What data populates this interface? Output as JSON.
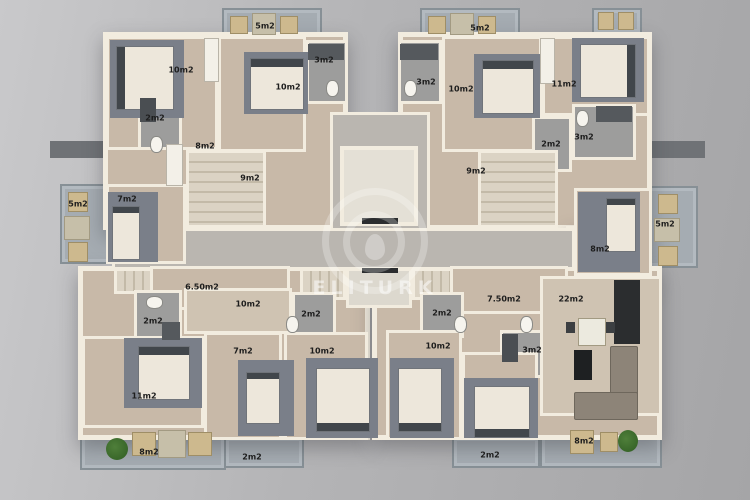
{
  "watermark": {
    "text": "ELITURK"
  },
  "colors": {
    "background": "#b4b4b6",
    "wall": "#f2ecdf",
    "wood_floor": "#c8b9a8",
    "tile_floor": "#9d9d9c",
    "balcony_floor": "#a5acb2",
    "rug": "#7a7f89",
    "ledge": "#6f7276",
    "label_text": "#1d1d1d",
    "watermark_white": "rgba(255,255,255,0.45)"
  },
  "plan": {
    "type": "residential-floor-plan",
    "units": 4,
    "rooms": [
      {
        "label": "5m2",
        "kind": "balcony",
        "x": 265,
        "y": 26
      },
      {
        "label": "5m2",
        "kind": "balcony",
        "x": 480,
        "y": 28
      },
      {
        "label": "10m2",
        "kind": "bedroom",
        "x": 181,
        "y": 70
      },
      {
        "label": "10m2",
        "kind": "bedroom",
        "x": 288,
        "y": 87
      },
      {
        "label": "3m2",
        "kind": "bathroom",
        "x": 324,
        "y": 60
      },
      {
        "label": "3m2",
        "kind": "bathroom",
        "x": 426,
        "y": 82
      },
      {
        "label": "10m2",
        "kind": "bedroom",
        "x": 461,
        "y": 89
      },
      {
        "label": "11m2",
        "kind": "bedroom",
        "x": 564,
        "y": 84
      },
      {
        "label": "2m2",
        "kind": "wc",
        "x": 155,
        "y": 118
      },
      {
        "label": "8m2",
        "kind": "hall",
        "x": 205,
        "y": 146
      },
      {
        "label": "2m2",
        "kind": "wc",
        "x": 551,
        "y": 144
      },
      {
        "label": "3m2",
        "kind": "bathroom",
        "x": 584,
        "y": 137
      },
      {
        "label": "9m2",
        "kind": "stairs",
        "x": 250,
        "y": 178
      },
      {
        "label": "9m2",
        "kind": "stairs",
        "x": 476,
        "y": 171
      },
      {
        "label": "7m2",
        "kind": "bedroom",
        "x": 127,
        "y": 199
      },
      {
        "label": "5m2",
        "kind": "balcony",
        "x": 78,
        "y": 204
      },
      {
        "label": "5m2",
        "kind": "balcony",
        "x": 665,
        "y": 224
      },
      {
        "label": "8m2",
        "kind": "bedroom",
        "x": 600,
        "y": 249
      },
      {
        "label": "6.50m2",
        "kind": "hall",
        "x": 202,
        "y": 287
      },
      {
        "label": "7.50m2",
        "kind": "hall",
        "x": 504,
        "y": 299
      },
      {
        "label": "22m2",
        "kind": "living-kitchen",
        "x": 571,
        "y": 299
      },
      {
        "label": "10m2",
        "kind": "hall",
        "x": 248,
        "y": 304
      },
      {
        "label": "2m2",
        "kind": "bathroom",
        "x": 153,
        "y": 321
      },
      {
        "label": "2m2",
        "kind": "wc",
        "x": 311,
        "y": 314
      },
      {
        "label": "2m2",
        "kind": "wc",
        "x": 442,
        "y": 313
      },
      {
        "label": "10m2",
        "kind": "bedroom",
        "x": 438,
        "y": 346
      },
      {
        "label": "3m2",
        "kind": "bathroom",
        "x": 532,
        "y": 350
      },
      {
        "label": "7m2",
        "kind": "bedroom",
        "x": 243,
        "y": 351
      },
      {
        "label": "10m2",
        "kind": "bedroom",
        "x": 322,
        "y": 351
      },
      {
        "label": "11m2",
        "kind": "bedroom",
        "x": 144,
        "y": 396
      },
      {
        "label": "8m2",
        "kind": "balcony",
        "x": 149,
        "y": 452
      },
      {
        "label": "2m2",
        "kind": "balcony",
        "x": 252,
        "y": 457
      },
      {
        "label": "2m2",
        "kind": "balcony",
        "x": 490,
        "y": 455
      },
      {
        "label": "8m2",
        "kind": "balcony",
        "x": 584,
        "y": 441
      }
    ]
  }
}
